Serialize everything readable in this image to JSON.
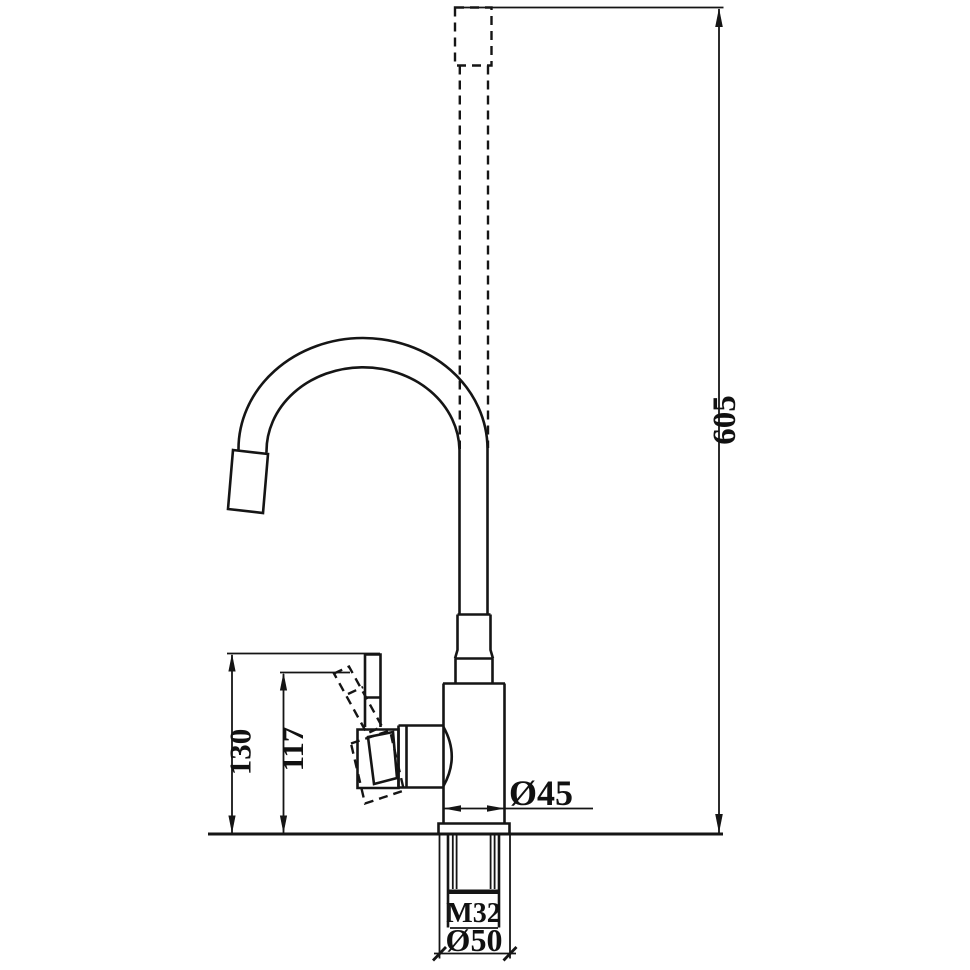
{
  "drawing": {
    "kind": "technical-dimension-drawing",
    "labels": {
      "total_height": "605",
      "handle_height_upright": "130",
      "handle_height_tilted": "117",
      "body_diameter": "Ø45",
      "thread_size": "M32",
      "base_diameter": "Ø50"
    },
    "colors": {
      "line": "#151515",
      "background": "#ffffff"
    }
  }
}
